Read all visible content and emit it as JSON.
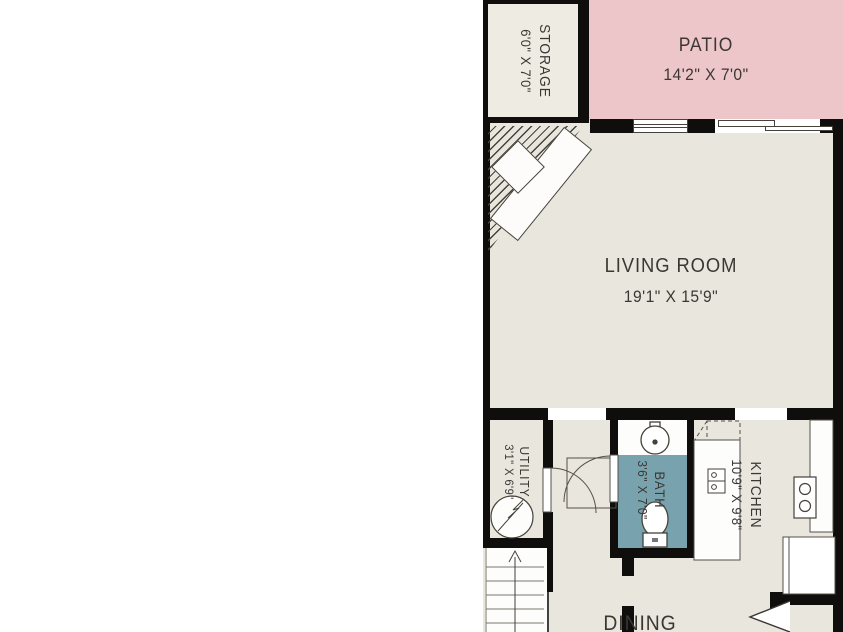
{
  "rooms": {
    "storage": {
      "name": "STORAGE",
      "dims": "6'0\" X 7'0\""
    },
    "patio": {
      "name": "PATIO",
      "dims": "14'2\" X 7'0\""
    },
    "living_room": {
      "name": "LIVING ROOM",
      "dims": "19'1\" X 15'9\""
    },
    "utility": {
      "name": "UTILITY",
      "dims": "3'1\" X 6'9\""
    },
    "bath": {
      "name": "BATH",
      "dims": "3'6\" X 7'0\""
    },
    "kitchen": {
      "name": "KITCHEN",
      "dims": "10'9\" X 9'8\""
    },
    "dining": {
      "name": "DINING"
    }
  },
  "fixtures": [
    "staircase",
    "water-heater",
    "door-swing",
    "bath-sink",
    "toilet",
    "kitchen-sink",
    "stove",
    "refrigerator",
    "window",
    "sliding-door"
  ],
  "colors": {
    "wall": "#0f0e0c",
    "floor": "#e9e6de",
    "storage_floor": "#eeebe3",
    "patio": "#edc6ca",
    "bath": "#78a3ae",
    "line": "#45413b",
    "text": "#3b3733",
    "background": "#ffffff"
  }
}
